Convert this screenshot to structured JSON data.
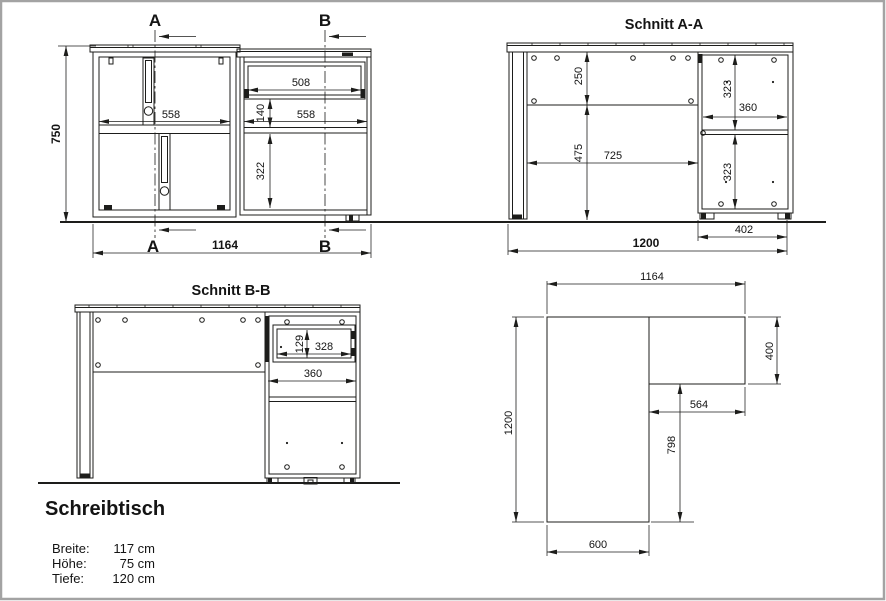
{
  "meta": {
    "background": "#ffffff",
    "line_color": "#1d1d1b",
    "frame_color": "#a3a3a3"
  },
  "product": {
    "title": "Schreibtisch",
    "specs": [
      {
        "label": "Breite:",
        "value": "117 cm"
      },
      {
        "label": "Höhe:",
        "value": "75 cm"
      },
      {
        "label": "Tiefe:",
        "value": "120 cm"
      }
    ]
  },
  "front_view": {
    "marker_a": "A",
    "marker_b": "B",
    "dims": {
      "height": "750",
      "width": "1164",
      "left_cabinet_width": "558",
      "drawer_width": "508",
      "drawer_to_shelf": "140",
      "right_cabinet_width": "558",
      "compartment_height": "322"
    }
  },
  "section_aa": {
    "title": "Schnitt A-A",
    "dims": {
      "back_panel_height": "250",
      "lower_height": "475",
      "inner_depth": "725",
      "total_depth": "1200",
      "upper_compartment": "323",
      "shelf_depth": "360",
      "lower_compartment": "323",
      "pedestal_depth": "402"
    }
  },
  "section_bb": {
    "title": "Schnitt B-B",
    "dims": {
      "drawer_height": "129",
      "drawer_depth": "328",
      "opening_depth": "360"
    }
  },
  "plan_view": {
    "dims": {
      "total_width": "1164",
      "total_depth": "1200",
      "return_depth": "400",
      "return_width": "564",
      "inner_depth": "798",
      "desk_width": "600"
    }
  }
}
